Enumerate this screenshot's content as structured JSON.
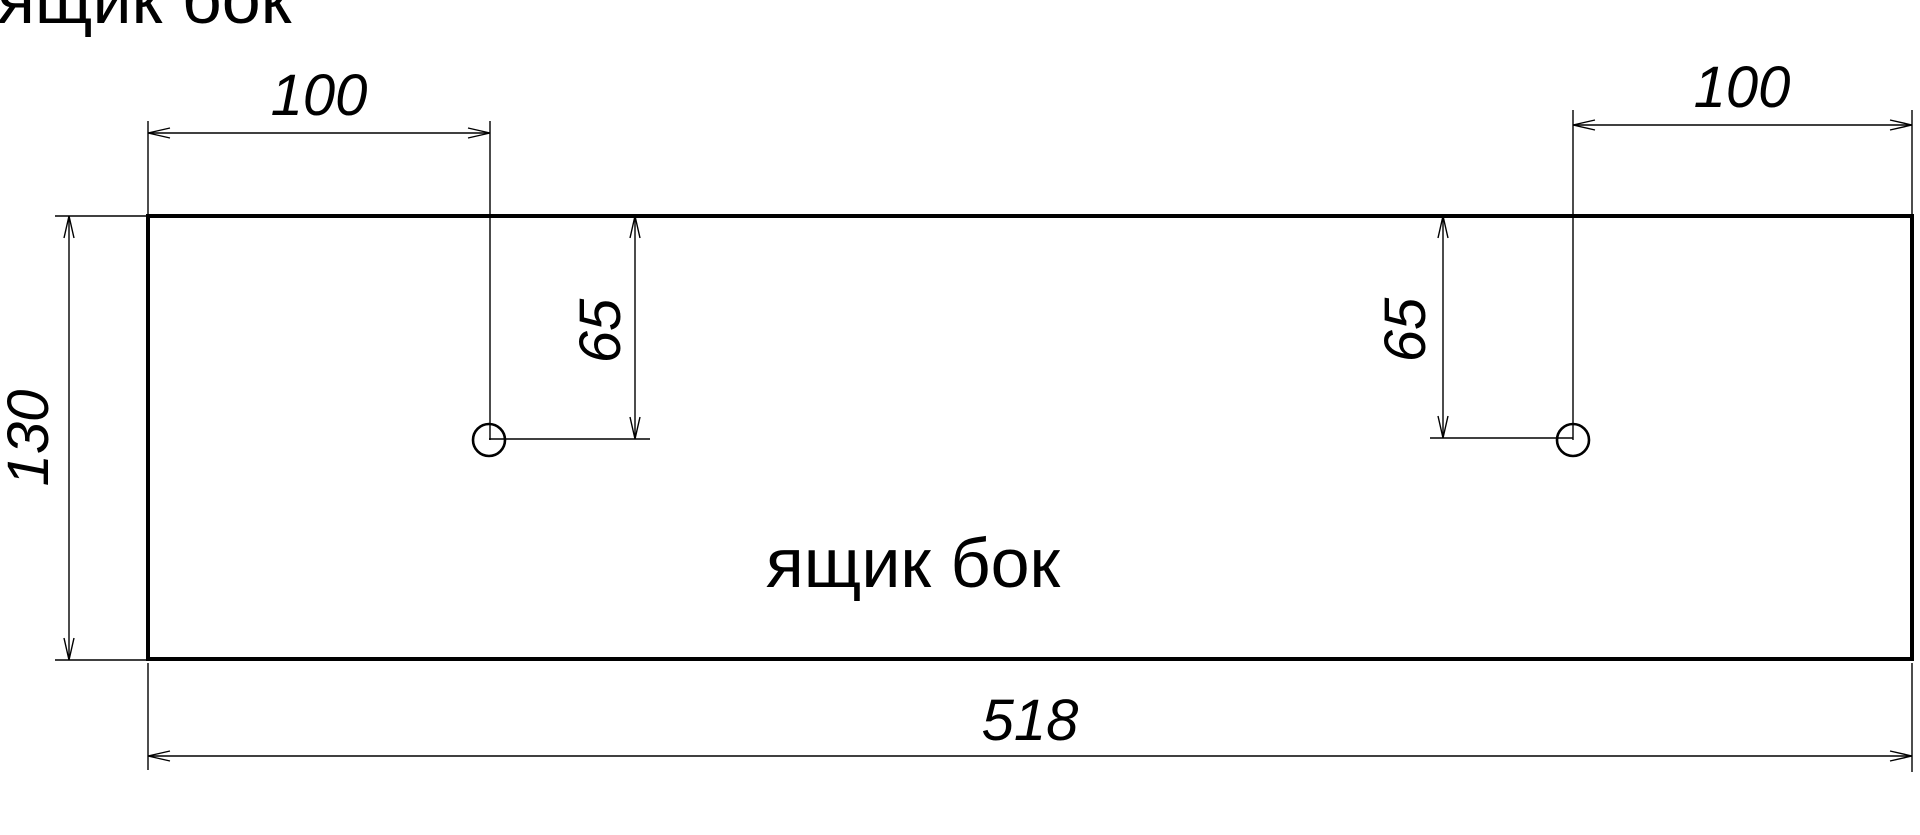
{
  "drawing": {
    "title": "ящик бок",
    "part_label": "ящик бок",
    "dimensions": {
      "total_width": "518",
      "total_height": "130",
      "hole_left_offset_x": "100",
      "hole_right_offset_x": "100",
      "hole_left_offset_y": "65",
      "hole_right_offset_y": "65"
    },
    "colors": {
      "line": "#000000",
      "background": "#ffffff"
    }
  }
}
